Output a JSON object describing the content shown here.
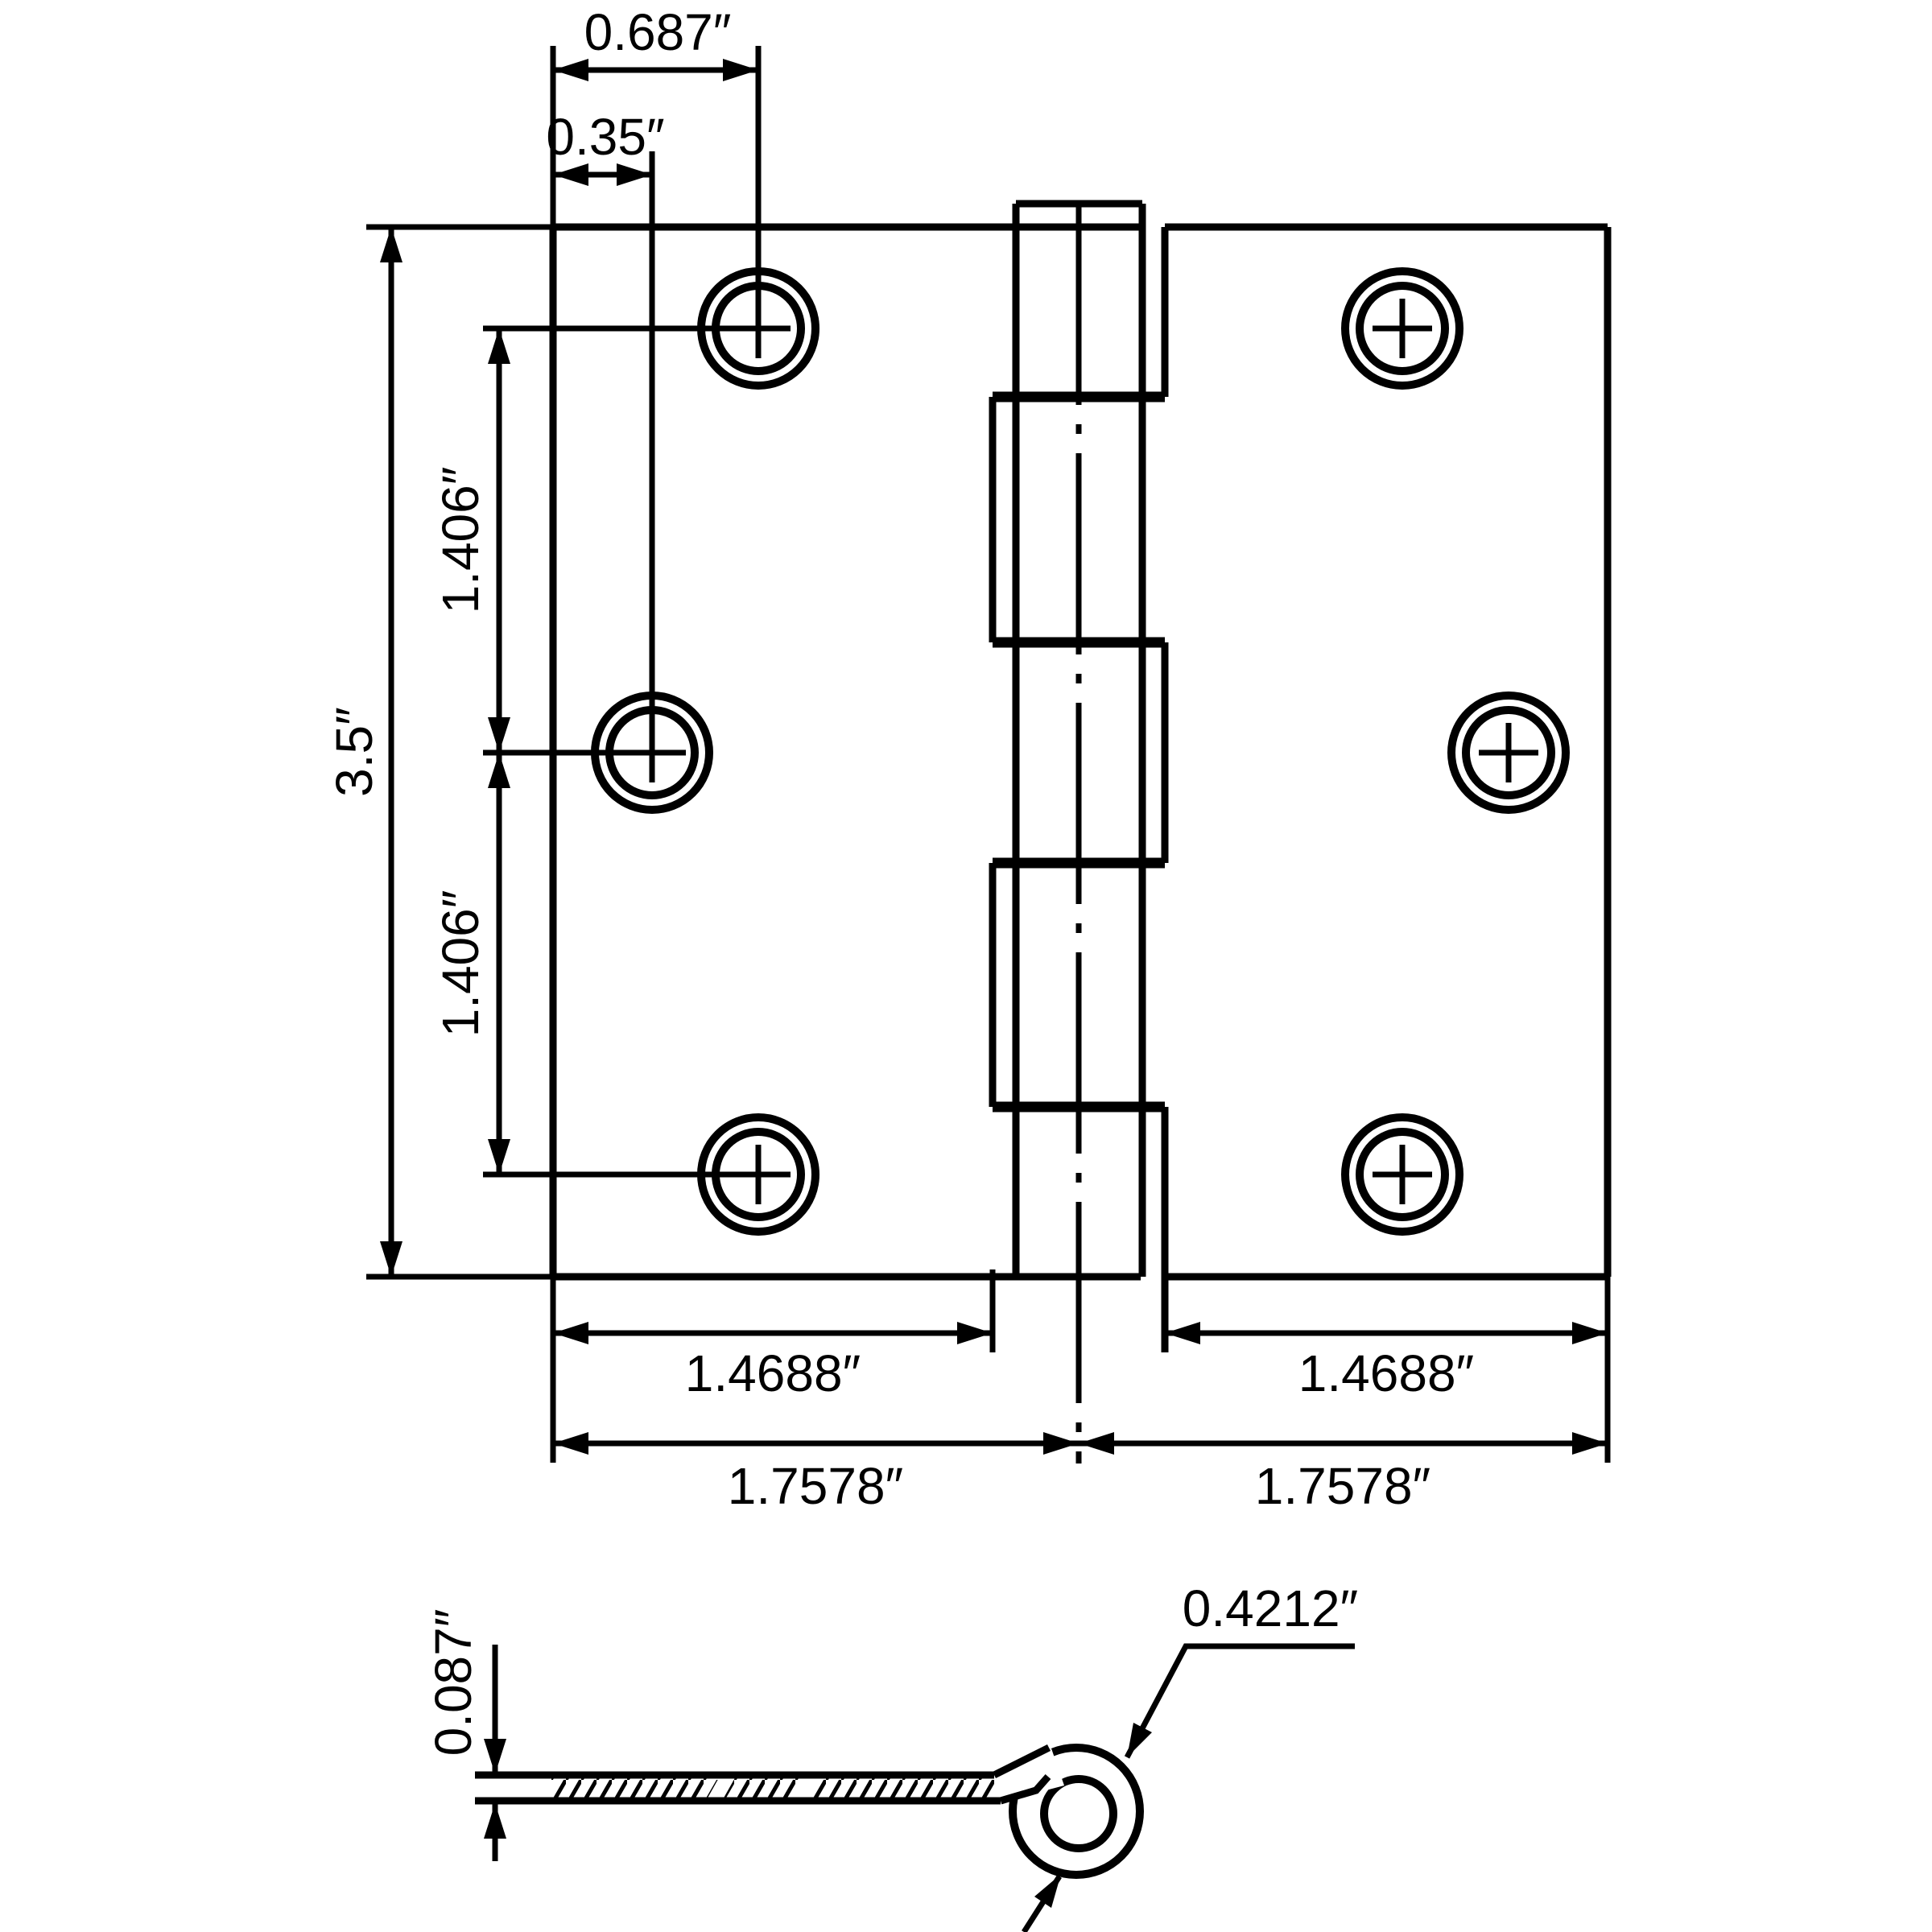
{
  "colors": {
    "ink": "#000000",
    "paper": "#ffffff"
  },
  "front_view": {
    "dim_hole_offset": "0.687″",
    "dim_hole_inset": "0.35″",
    "dim_height": "3.5″",
    "dim_hole_spacing_upper": "1.406″",
    "dim_hole_spacing_lower": "1.406″",
    "dim_leaf_width_left": "1.4688″",
    "dim_leaf_width_right": "1.4688″",
    "dim_half_width_left": "1.7578″",
    "dim_half_width_right": "1.7578″"
  },
  "profile_view": {
    "dim_thickness": "0.087″",
    "dim_curl_diameter": "0.4212″"
  }
}
